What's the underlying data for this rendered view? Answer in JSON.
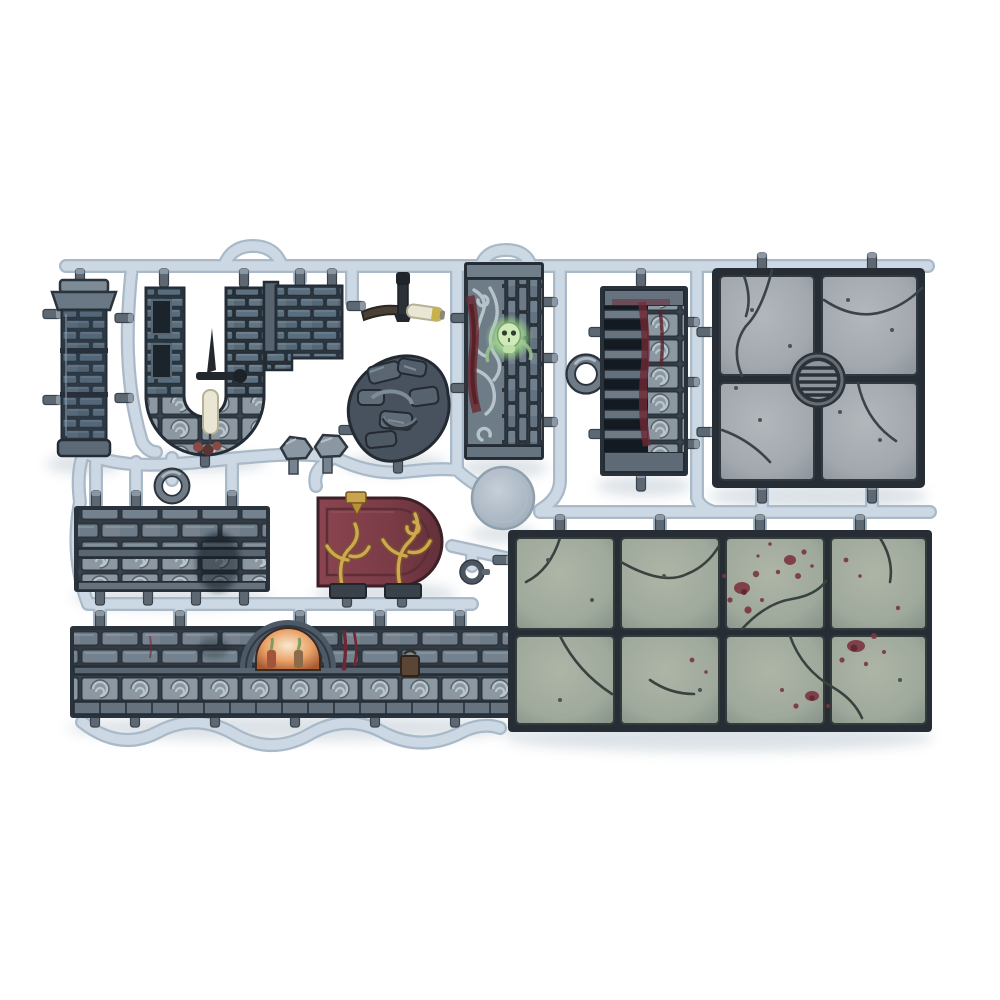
{
  "scene": {
    "description": "Product photo of a plastic model sprue containing painted dungeon terrain pieces on a white background",
    "background_color": "#ffffff"
  },
  "palette": {
    "runner": "#ccd8e3",
    "runner_edge": "#a9b9c8",
    "grout": "#262d35",
    "stone_mid": "#73828e",
    "stone_dark": "#2b333c",
    "stone_light": "#b9c4cb",
    "blood": "#7b3742",
    "gold": "#cfa84f",
    "door_edge": "#3c1f27",
    "glow_green": "#9fd98e",
    "glow_orange": "#eba46a",
    "candle": "#e9e7d4"
  },
  "pieces": [
    {
      "id": "stone-column",
      "label": "Stone column with capital"
    },
    {
      "id": "archway",
      "label": "U-shaped stone archway with candle"
    },
    {
      "id": "wall-corner",
      "label": "Corner brick wall section"
    },
    {
      "id": "torch-bracket",
      "label": "Wall bracket with mounted candle"
    },
    {
      "id": "rubble-pile",
      "label": "Pile of rubble"
    },
    {
      "id": "carved-obelisk",
      "label": "Carved tentacle wall with glowing green skull and blood smear"
    },
    {
      "id": "barred-wall",
      "label": "Barred grate wall with ring handle and blood stains"
    },
    {
      "id": "floor-tile-2x2",
      "label": "2x2 cracked floor tile with round drain grate"
    },
    {
      "id": "wall-with-ring",
      "label": "Brick wall section with hanging ring and scorch mark"
    },
    {
      "id": "wooden-door",
      "label": "Round-topped red door with gold tentacle hinges"
    },
    {
      "id": "round-base",
      "label": "Plain round disc"
    },
    {
      "id": "small-stones",
      "label": "Two small stone bits"
    },
    {
      "id": "long-wall-fireplace",
      "label": "Long wall with glowing orange arch and blood drips"
    },
    {
      "id": "floor-tile-4x2",
      "label": "4x2 cracked floor tiles with blood spatter"
    }
  ]
}
